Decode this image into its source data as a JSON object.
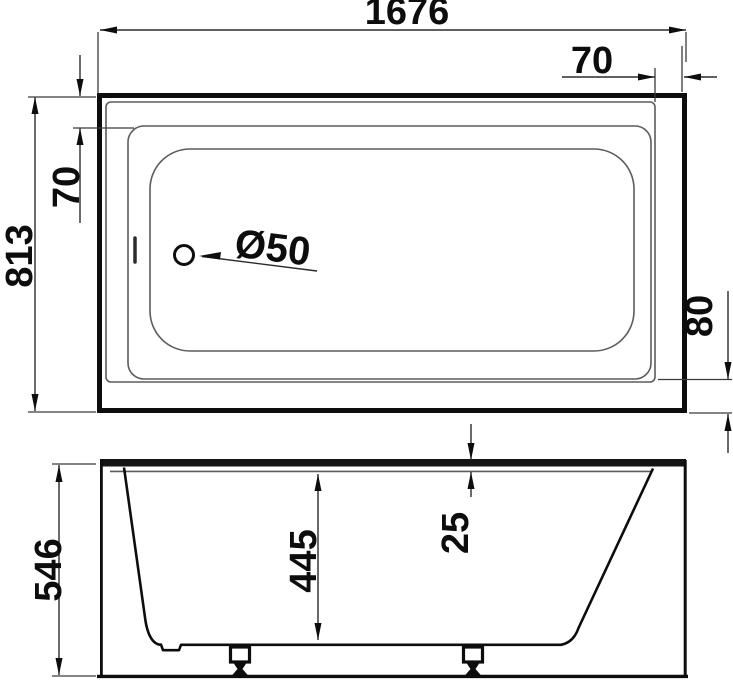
{
  "page": {
    "title": "Bathtub technical dimension drawing",
    "background_color": "#ffffff",
    "thin_line_color": "#5c5c5c",
    "outline_color": "#0d0d0d",
    "dimension_line_color": "#2b2b2b"
  },
  "top_view": {
    "label": "bathtub-plan-view",
    "dimensions": {
      "overall_length": "1676",
      "rim_width_right": "70",
      "rim_width_top": "70",
      "overall_width": "813",
      "rim_width_bottom": "80",
      "drain_diameter": "Ø50"
    }
  },
  "front_view": {
    "label": "bathtub-front-view",
    "dimensions": {
      "overall_height": "546",
      "inner_depth": "445",
      "rim_thickness": "25"
    }
  }
}
